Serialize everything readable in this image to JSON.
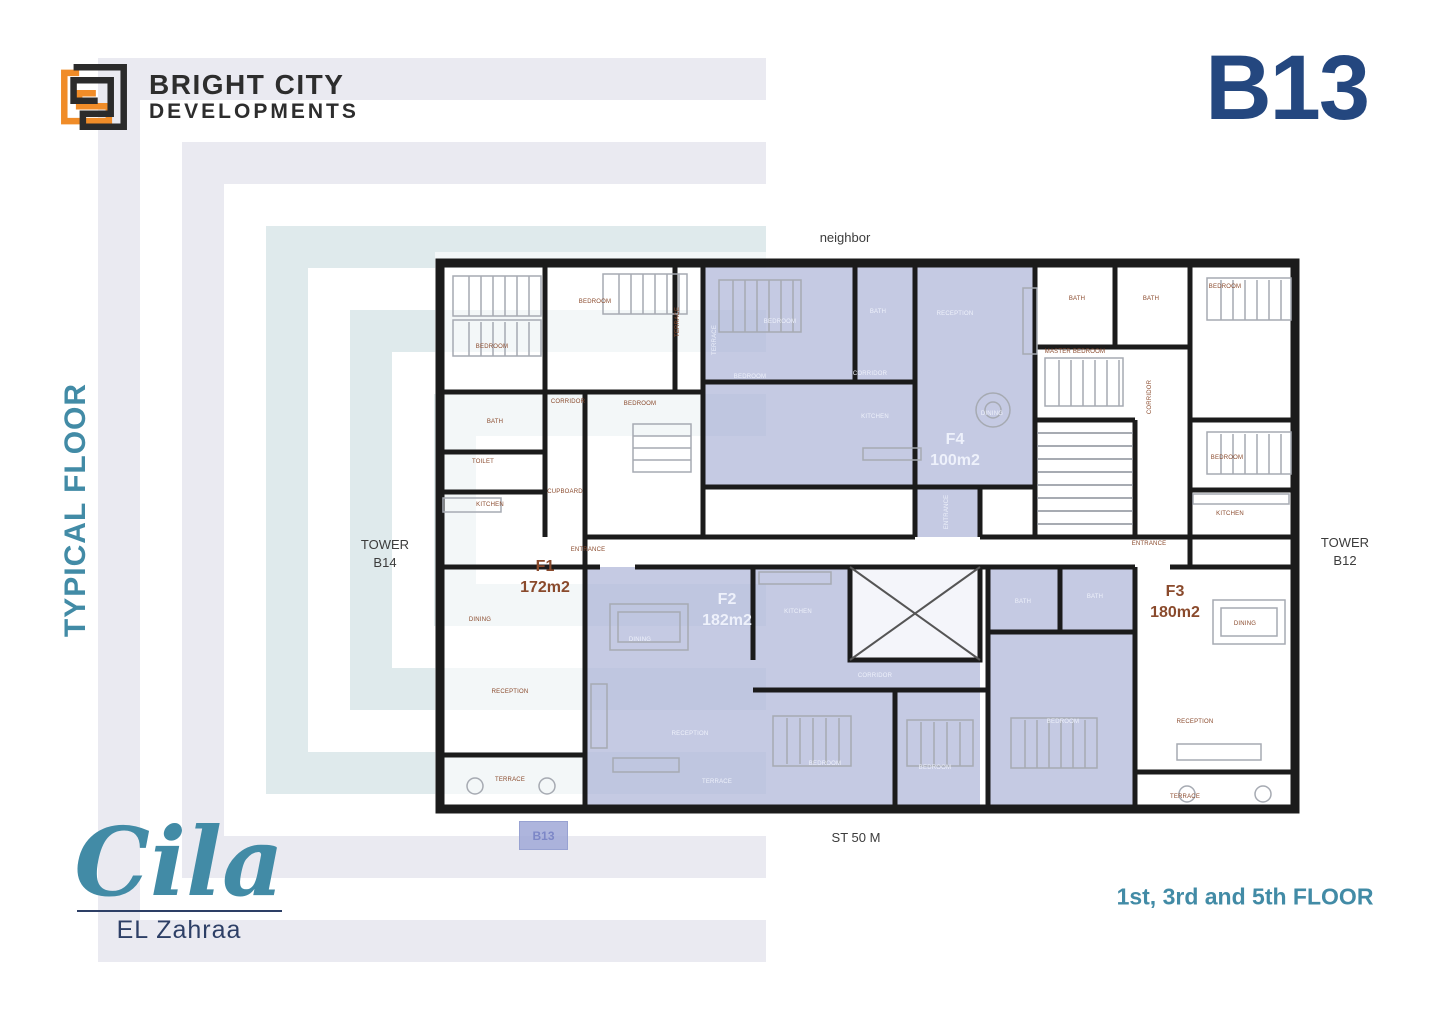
{
  "header": {
    "brand_line1": "BRIGHT CITY",
    "brand_line2": "DEVELOPMENTS",
    "building_code": "B13"
  },
  "side_label": "TYPICAL FLOOR",
  "context": {
    "neighbor": "neighbor",
    "tower_left_line1": "TOWER",
    "tower_left_line2": "B14",
    "tower_right_line1": "TOWER",
    "tower_right_line2": "B12",
    "street": "ST 50 M",
    "marker": "B13"
  },
  "units": [
    {
      "id": "F1",
      "area": "172m2"
    },
    {
      "id": "F2",
      "area": "182m2"
    },
    {
      "id": "F3",
      "area": "180m2"
    },
    {
      "id": "F4",
      "area": "100m2"
    }
  ],
  "plan": {
    "rooms": [
      {
        "t": "BEDROOM",
        "x": 57,
        "y": 95
      },
      {
        "t": "BEDROOM",
        "x": 160,
        "y": 50
      },
      {
        "t": "TERRACE",
        "x": 243,
        "y": 70,
        "v": 1
      },
      {
        "t": "BEDROOM",
        "x": 205,
        "y": 152
      },
      {
        "t": "CORRIDOR",
        "x": 133,
        "y": 150
      },
      {
        "t": "BATH",
        "x": 60,
        "y": 170
      },
      {
        "t": "TOILET",
        "x": 48,
        "y": 210
      },
      {
        "t": "KITCHEN",
        "x": 55,
        "y": 253
      },
      {
        "t": "CUPBOARD",
        "x": 130,
        "y": 240
      },
      {
        "t": "ENTRANCE",
        "x": 153,
        "y": 298
      },
      {
        "t": "DINING",
        "x": 45,
        "y": 368
      },
      {
        "t": "RECEPTION",
        "x": 75,
        "y": 440
      },
      {
        "t": "TERRACE",
        "x": 75,
        "y": 528
      },
      {
        "t": "BEDROOM",
        "x": 345,
        "y": 70,
        "c": "w"
      },
      {
        "t": "BATH",
        "x": 443,
        "y": 60,
        "c": "w"
      },
      {
        "t": "RECEPTION",
        "x": 520,
        "y": 62,
        "c": "w"
      },
      {
        "t": "TERRACE",
        "x": 280,
        "y": 88,
        "c": "w",
        "v": 1
      },
      {
        "t": "BEDROOM",
        "x": 315,
        "y": 125,
        "c": "w"
      },
      {
        "t": "CORRIDOR",
        "x": 435,
        "y": 122,
        "c": "w"
      },
      {
        "t": "KITCHEN",
        "x": 440,
        "y": 165,
        "c": "w"
      },
      {
        "t": "DINING",
        "x": 557,
        "y": 162,
        "c": "w"
      },
      {
        "t": "ENTRANCE",
        "x": 512,
        "y": 260,
        "c": "w",
        "v": 1
      },
      {
        "t": "BATH",
        "x": 642,
        "y": 47
      },
      {
        "t": "BATH",
        "x": 716,
        "y": 47
      },
      {
        "t": "BEDROOM",
        "x": 790,
        "y": 35
      },
      {
        "t": "MASTER BEDROOM",
        "x": 640,
        "y": 100
      },
      {
        "t": "CORRIDOR",
        "x": 715,
        "y": 145,
        "v": 1
      },
      {
        "t": "BEDROOM",
        "x": 792,
        "y": 206
      },
      {
        "t": "KITCHEN",
        "x": 795,
        "y": 262
      },
      {
        "t": "ENTRANCE",
        "x": 714,
        "y": 292
      },
      {
        "t": "DINING",
        "x": 810,
        "y": 372
      },
      {
        "t": "RECEPTION",
        "x": 760,
        "y": 470
      },
      {
        "t": "TERRACE",
        "x": 750,
        "y": 545
      },
      {
        "t": "KITCHEN",
        "x": 363,
        "y": 360,
        "c": "w"
      },
      {
        "t": "CORRIDOR",
        "x": 440,
        "y": 424,
        "c": "w"
      },
      {
        "t": "DINING",
        "x": 205,
        "y": 388,
        "c": "w"
      },
      {
        "t": "RECEPTION",
        "x": 255,
        "y": 482,
        "c": "w"
      },
      {
        "t": "BEDROOM",
        "x": 390,
        "y": 512,
        "c": "w"
      },
      {
        "t": "BEDROOM",
        "x": 500,
        "y": 516,
        "c": "w"
      },
      {
        "t": "TERRACE",
        "x": 282,
        "y": 530,
        "c": "w"
      },
      {
        "t": "BATH",
        "x": 588,
        "y": 350,
        "c": "w"
      },
      {
        "t": "BATH",
        "x": 660,
        "y": 345,
        "c": "w"
      },
      {
        "t": "BEDROOM",
        "x": 628,
        "y": 470,
        "c": "w"
      }
    ]
  },
  "footer": {
    "project_name": "Cila",
    "project_sub": "EL Zahraa",
    "floors_note": "1st, 3rd and 5th FLOOR"
  },
  "colors": {
    "navy": "#24477F",
    "teal": "#428BA6",
    "orange": "#F08C28",
    "highlight_purple": "#8C96C8",
    "label_brown": "#8A4A2C",
    "wall_black": "#1B1B1B"
  }
}
